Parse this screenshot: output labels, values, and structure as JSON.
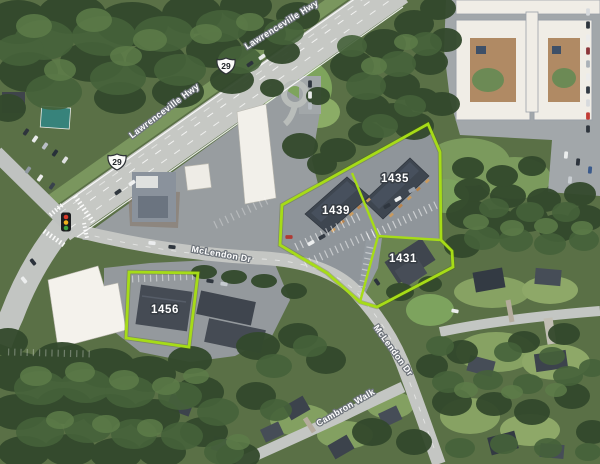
{
  "map": {
    "road_labels": [
      {
        "text": "Lawrenceville Hwy"
      },
      {
        "text": "Lawrenceville Hwy"
      },
      {
        "text": "McLendon Dr"
      },
      {
        "text": "McLendon Dr"
      },
      {
        "text": "Cambron Walk"
      }
    ],
    "route_shields": [
      {
        "number": "29"
      },
      {
        "number": "29"
      }
    ],
    "parcels": [
      {
        "id": "1439"
      },
      {
        "id": "1435"
      },
      {
        "id": "1431"
      },
      {
        "id": "1456"
      }
    ],
    "colors": {
      "parcel_outline": "#a6dc17",
      "parcel_label_fill": "#ffffff",
      "parcel_label_halo": "#363c43",
      "road_label_fill": "#ffffff",
      "road_label_halo": "#6e747b",
      "traffic_light_red": "#d93a2b",
      "traffic_light_yellow": "#f1b31c",
      "traffic_light_green": "#3da13f"
    }
  }
}
